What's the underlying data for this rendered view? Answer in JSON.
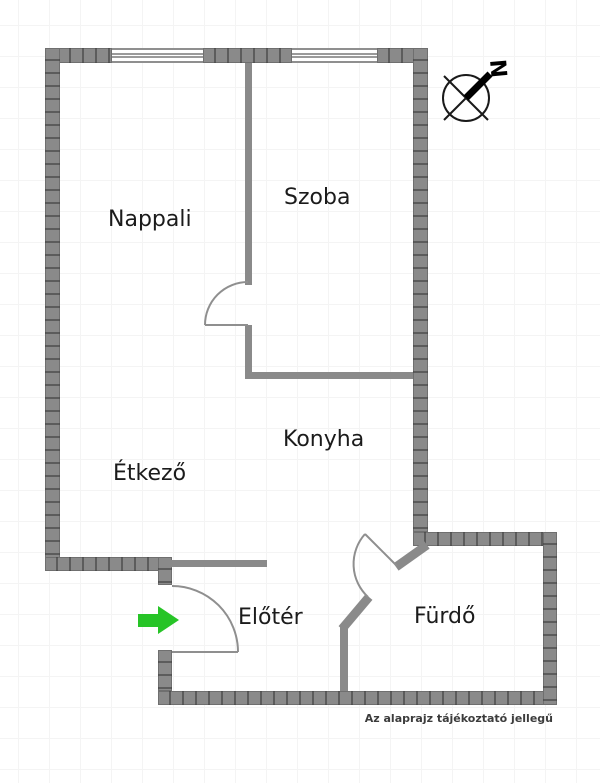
{
  "floorplan": {
    "rooms": [
      {
        "id": "nappali",
        "name": "Nappali"
      },
      {
        "id": "szoba",
        "name": "Szoba"
      },
      {
        "id": "konyha",
        "name": "Konyha"
      },
      {
        "id": "etkezo",
        "name": "Étkező"
      },
      {
        "id": "eloter",
        "name": "Előtér"
      },
      {
        "id": "furdo",
        "name": "Fürdő"
      }
    ],
    "compass": {
      "label": "N"
    },
    "entrance_arrow": {
      "direction": "right",
      "color": "#27c427"
    },
    "disclaimer": "Az alaprajz tájékoztató jellegű",
    "colors": {
      "wall": "#8a8a8a",
      "wall_divider": "#5c5c5c",
      "door_line": "#8f8f8f",
      "text": "#1b1b1b",
      "grid": "#f4f4f4"
    }
  }
}
